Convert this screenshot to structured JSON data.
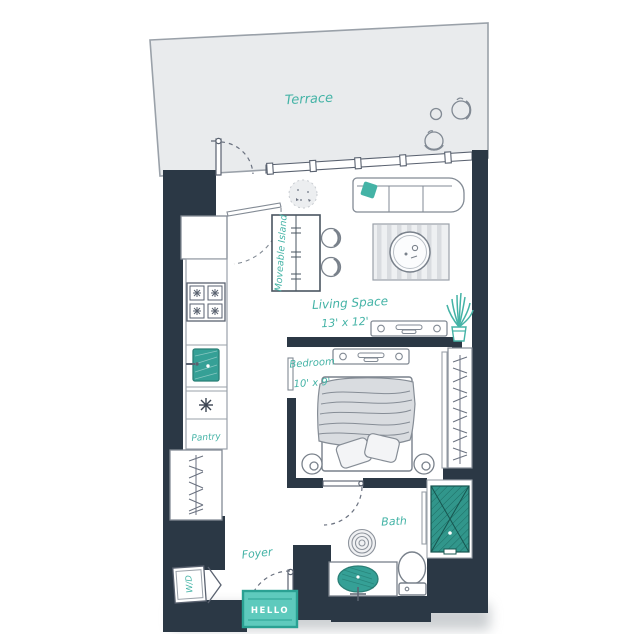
{
  "palette": {
    "wall": "#2b3845",
    "teal_label": "#44b3a6",
    "teal_shower": "#31968b",
    "teal_sink": "#35a096",
    "mat_fill": "#5ecabd",
    "mat_border": "#2aa193",
    "terrace_fill": "#e9ebed",
    "furniture_line": "#828a94",
    "soft_gray": "#d9dce0"
  },
  "rooms": {
    "terrace": {
      "label": "Terrace"
    },
    "living": {
      "label": "Living Space",
      "dimensions": "13' x 12'"
    },
    "bedroom": {
      "label": "Bedroom",
      "dimensions": "10' x 9'"
    },
    "bath": {
      "label": "Bath"
    },
    "foyer": {
      "label": "Foyer"
    },
    "pantry": {
      "label": "Pantry"
    }
  },
  "fixtures": {
    "island_label": "Moveable Island",
    "washer_dryer_label": "W/D",
    "doormat_text": "HELLO"
  }
}
